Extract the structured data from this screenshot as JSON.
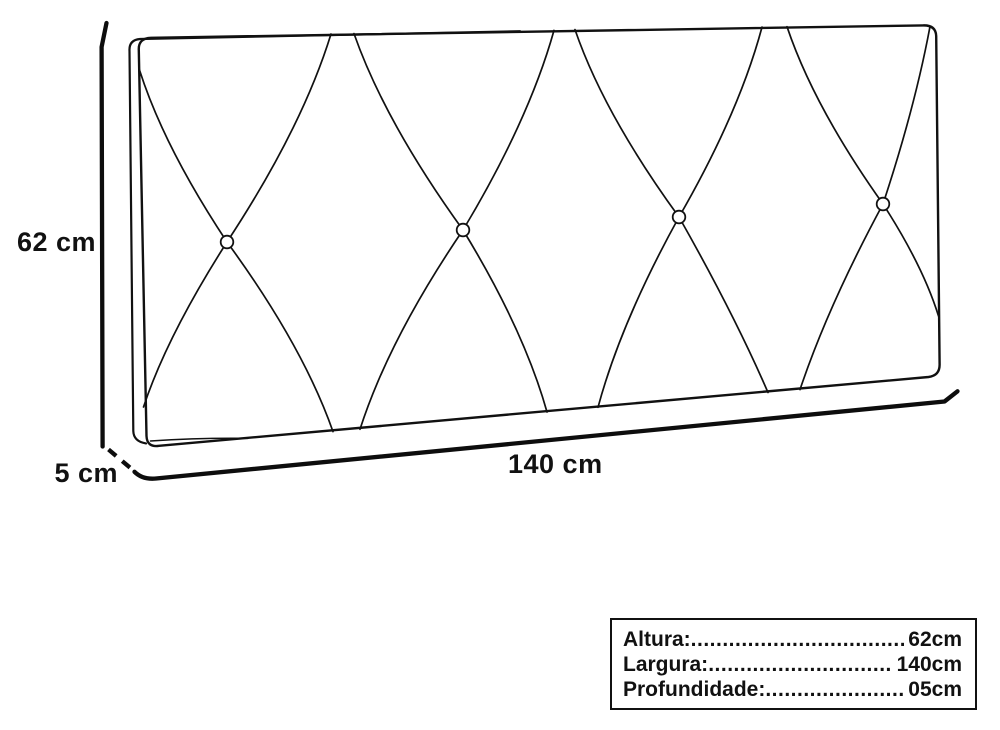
{
  "colors": {
    "ink": "#111111",
    "background": "#ffffff"
  },
  "dimensions": {
    "height_label": "62 cm",
    "depth_label": "5 cm",
    "width_label": "140 cm"
  },
  "spec_table": {
    "leader": "......................................................................................................",
    "rows": [
      {
        "label": "Altura:",
        "value": "62cm"
      },
      {
        "label": "Largura:",
        "value": "140cm"
      },
      {
        "label": "Profundidade:",
        "value": "05cm"
      }
    ]
  }
}
